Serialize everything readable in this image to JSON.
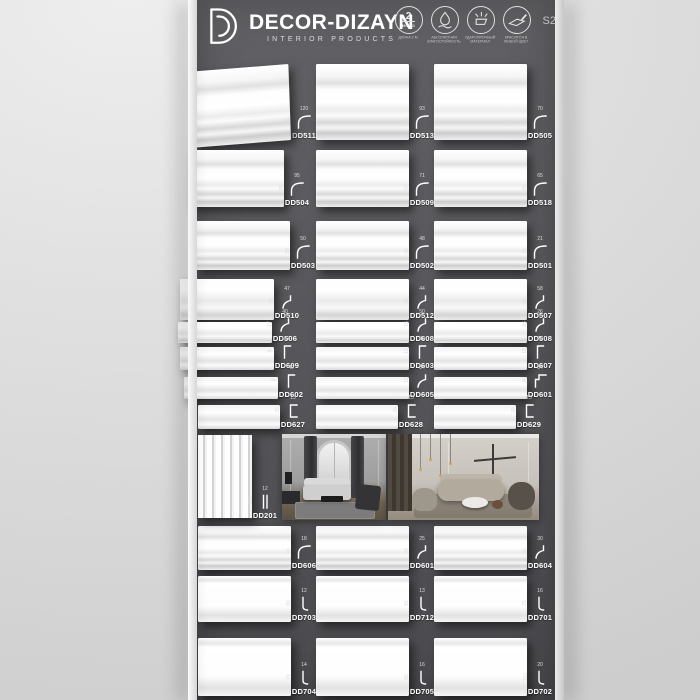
{
  "header": {
    "brand": "DECOR-DIZAYN",
    "subtitle": "INTERIOR PRODUCTS",
    "series": "S2",
    "badges": [
      {
        "icon": "length-2m-icon",
        "circle_main": "2",
        "circle_sub": "метра",
        "caption": "ДЛИНА 2 М"
      },
      {
        "icon": "water-drop-icon",
        "caption": "АБСОЛЮТНАЯ ВЛАГОСТОЙКОСТЬ"
      },
      {
        "icon": "impact-resistance-icon",
        "caption": "УДАРОПРОЧНЫЙ МАТЕРИАЛ"
      },
      {
        "icon": "paint-brush-icon",
        "caption": "КРАСИТСЯ В ЛЮБОЙ ЦВЕТ"
      }
    ]
  },
  "colors": {
    "panel": "#58585c",
    "wall": "#dedede",
    "sample": "#ffffff",
    "text": "#ffffff"
  },
  "board": {
    "rows": [
      {
        "top": 64,
        "sample_h": 76,
        "sample_w": 98,
        "style": "crown",
        "overhang": 4,
        "items": [
          {
            "code": "DD511",
            "dim_w": "120",
            "dim_h": "80",
            "glyph": "crown"
          },
          {
            "code": "DD513",
            "dim_w": "93",
            "dim_h": "90",
            "glyph": "crown"
          },
          {
            "code": "DD505",
            "dim_w": "70",
            "dim_h": "80",
            "glyph": "crown"
          }
        ]
      },
      {
        "top": 150,
        "sample_h": 57,
        "sample_w": 94,
        "style": "crown",
        "overhang": 8,
        "items": [
          {
            "code": "DD504",
            "dim_w": "95",
            "dim_h": "75",
            "glyph": "crown"
          },
          {
            "code": "DD509",
            "dim_w": "71",
            "dim_h": "70",
            "glyph": "crown"
          },
          {
            "code": "DD518",
            "dim_w": "65",
            "dim_h": "45",
            "glyph": "crown"
          }
        ]
      },
      {
        "top": 221,
        "sample_h": 49,
        "sample_w": 94,
        "style": "crown",
        "overhang": 2,
        "items": [
          {
            "code": "DD503",
            "dim_w": "50",
            "dim_h": "50",
            "glyph": "crown"
          },
          {
            "code": "DD502",
            "dim_w": "48",
            "dim_h": "40",
            "glyph": "crown"
          },
          {
            "code": "DD501",
            "dim_w": "21",
            "dim_h": "75",
            "glyph": "crown"
          }
        ]
      },
      {
        "top": 279,
        "sample_h": 41,
        "sample_w": 94,
        "style": "cove",
        "overhang": 18,
        "items": [
          {
            "code": "DD510",
            "dim_w": "47",
            "dim_h": "25",
            "glyph": "cove"
          },
          {
            "code": "DD512",
            "dim_w": "44",
            "dim_h": "25",
            "glyph": "cove"
          },
          {
            "code": "DD507",
            "dim_w": "58",
            "dim_h": "35",
            "glyph": "cove"
          }
        ]
      },
      {
        "top": 322,
        "sample_h": 21,
        "sample_w": 94,
        "style": "cove",
        "overhang": 20,
        "items": [
          {
            "code": "DD506",
            "dim_w": "40",
            "dim_h": "17",
            "glyph": "cove"
          },
          {
            "code": "DD608",
            "dim_w": "50",
            "dim_h": "16",
            "glyph": "cove"
          },
          {
            "code": "DD508",
            "dim_w": "26",
            "dim_h": "16",
            "glyph": "cove"
          }
        ]
      },
      {
        "top": 347,
        "sample_h": 23,
        "sample_w": 94,
        "style": "flat",
        "overhang": 18,
        "items": [
          {
            "code": "DD609",
            "dim_w": "52",
            "dim_h": "9",
            "glyph": "flat"
          },
          {
            "code": "DD603",
            "dim_w": "40",
            "dim_h": "12",
            "glyph": "flat"
          },
          {
            "code": "DD607",
            "dim_w": "28",
            "dim_h": "15",
            "glyph": "flat"
          }
        ]
      },
      {
        "top": 377,
        "sample_h": 22,
        "sample_w": 94,
        "style": "flat",
        "overhang": 14,
        "items": [
          {
            "code": "DD602",
            "dim_w": "40",
            "dim_h": "8",
            "glyph": "flat"
          },
          {
            "code": "DD605",
            "dim_w": "34",
            "dim_h": "12",
            "glyph": "cove"
          },
          {
            "code": "DD601",
            "dim_w": "34",
            "dim_h": "34",
            "glyph": "angle"
          }
        ]
      },
      {
        "top": 405,
        "sample_h": 24,
        "sample_w": 82,
        "style": "flat",
        "overhang": 0,
        "items": [
          {
            "code": "DD627",
            "dim_w": "13",
            "dim_h": "25",
            "glyph": "channel"
          },
          {
            "code": "DD628",
            "dim_w": "13",
            "dim_h": "25",
            "glyph": "channel"
          },
          {
            "code": "DD629",
            "dim_w": "13",
            "dim_h": "25",
            "glyph": "channel"
          }
        ]
      },
      {
        "top": 526,
        "sample_h": 44,
        "sample_w": 93,
        "style": "crown",
        "overhang": 0,
        "items": [
          {
            "code": "DD606",
            "dim_w": "18",
            "dim_h": "44",
            "glyph": "crown"
          },
          {
            "code": "DD601",
            "dim_w": "25",
            "dim_h": "44",
            "glyph": "cove"
          },
          {
            "code": "DD604",
            "dim_w": "30",
            "dim_h": "30",
            "glyph": "cove"
          }
        ]
      },
      {
        "top": 576,
        "sample_h": 46,
        "sample_w": 96,
        "style": "plinth",
        "overhang": 0,
        "items": [
          {
            "code": "DD703",
            "dim_w": "12",
            "dim_h": "80",
            "glyph": "plinth"
          },
          {
            "code": "DD712",
            "dim_w": "13",
            "dim_h": "81",
            "glyph": "plinth"
          },
          {
            "code": "DD701",
            "dim_w": "16",
            "dim_h": "75",
            "glyph": "plinth"
          }
        ]
      },
      {
        "top": 638,
        "sample_h": 58,
        "sample_w": 99,
        "style": "plinth",
        "overhang": 0,
        "items": [
          {
            "code": "DD704",
            "dim_w": "14",
            "dim_h": "79",
            "glyph": "plinth"
          },
          {
            "code": "DD705",
            "dim_w": "16",
            "dim_h": "95",
            "glyph": "plinth"
          },
          {
            "code": "DD702",
            "dim_w": "20",
            "dim_h": "110",
            "glyph": "plinth"
          }
        ]
      }
    ],
    "gallery": {
      "panel": {
        "code": "DD201",
        "dim_w": "12",
        "dim_h": "130",
        "glyph": "panel"
      }
    }
  }
}
